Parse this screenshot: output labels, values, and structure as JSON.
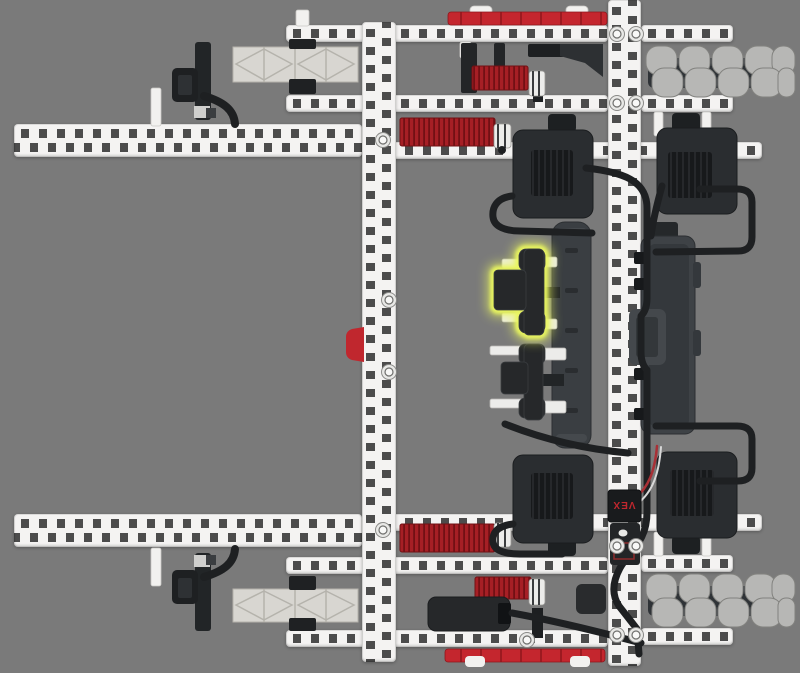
{
  "scene": {
    "description": "Top-down 3D render of a VEX V5 robot drivetrain assembly step",
    "background_color": "#7a7a7a",
    "highlighted_part": "bumper-switch",
    "highlight_state": "selected"
  },
  "labels": {
    "radio_logo": "VEX"
  },
  "colors": {
    "background": "#7a7a7a",
    "beam_white": "#f4f3f2",
    "hole_gray": "#4c4c4c",
    "gear_red": "#a61f25",
    "gear_red_dark": "#721014",
    "strip_red": "#c4262e",
    "motor_black": "#2a2d30",
    "vent_black": "#17191b",
    "battery_gray": "#3a3e42",
    "brain_gray": "#3e4246",
    "cable_black": "#1e2022",
    "roller_gray": "#b7b7b5",
    "hub_gray": "#2f3337",
    "truss_gray": "#d8d6d1",
    "part_black": "#26282a",
    "bumper_red": "#c0272e",
    "logo_red": "#c0272e",
    "highlight_yellow": "#e9f65e",
    "wire_red": "#a83036",
    "wire_white": "#d8d8d8"
  },
  "parts_visible": [
    "structural-beams",
    "long-arm-beams",
    "omni-wheels",
    "smart-motors",
    "red-gears",
    "battery",
    "robot-brain",
    "radio",
    "bumper-switch-highlighted",
    "bumper-switch",
    "truss-plates",
    "shaft-collars",
    "smart-cables"
  ]
}
